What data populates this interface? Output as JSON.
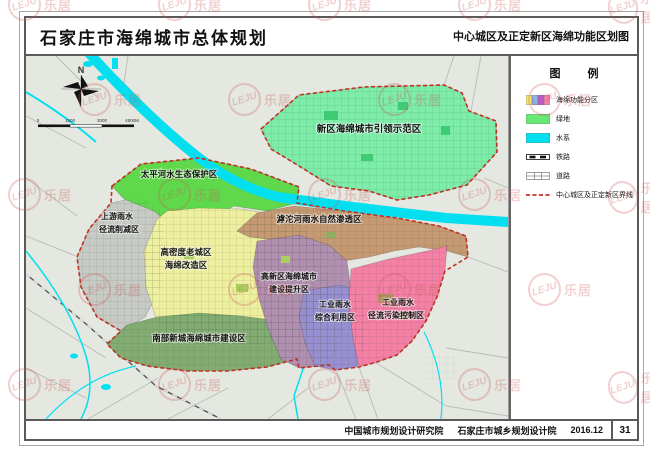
{
  "title_bar": {
    "left": "石家庄市海绵城市总体规划",
    "right": "中心城区及正定新区海绵功能区划图"
  },
  "compass": {
    "north_label": "N"
  },
  "scale_bar": {
    "ticks": [
      "0",
      "1500",
      "3000",
      "4500M"
    ]
  },
  "legend": {
    "title": "图 例",
    "items": [
      {
        "name": "sponge-function-zones",
        "label": "海绵功能分区",
        "colors": [
          "#f0e96e",
          "#8ab4ee",
          "#b95fd0",
          "#f583ab"
        ]
      },
      {
        "name": "green-space",
        "label": "绿地",
        "colors": [
          "#66e873"
        ]
      },
      {
        "name": "water-system",
        "label": "水系",
        "colors": [
          "#04dff0"
        ]
      },
      {
        "name": "railway",
        "label": "铁路",
        "colors": [
          "#222222"
        ]
      },
      {
        "name": "road",
        "label": "道路",
        "colors": [
          "#888888"
        ]
      },
      {
        "name": "boundary",
        "label": "中心城区及正定新区界线",
        "colors": [
          "#d42b20"
        ]
      }
    ]
  },
  "map": {
    "background": "#e4e8e1",
    "water_color": "#04dff0",
    "boundary_color": "#c03022",
    "zones": [
      {
        "id": "xinqu",
        "label": "新区海绵城市引领示范区",
        "label2": "",
        "color": "#7deda9"
      },
      {
        "id": "taipinghe",
        "label": "太平河水生态保护区",
        "label2": "",
        "color": "#5fd84b"
      },
      {
        "id": "shangyou",
        "label": "上游雨水",
        "label2": "径流削减区",
        "color": "#c7cac5"
      },
      {
        "id": "gaomidu",
        "label": "高密度老城区",
        "label2": "海绵改造区",
        "color": "#eef0a0"
      },
      {
        "id": "hutuohe",
        "label": "滹沱河雨水自然渗透区",
        "label2": "",
        "color": "#c59972"
      },
      {
        "id": "gaoxinqu",
        "label": "高新区海绵城市",
        "label2": "建设提升区",
        "color": "#b18fb0"
      },
      {
        "id": "gongye-liyong",
        "label": "工业雨水",
        "label2": "综合利用区",
        "color": "#988fd0"
      },
      {
        "id": "gongye-wuran",
        "label": "工业雨水",
        "label2": "径流污染控制区",
        "color": "#f480a6"
      },
      {
        "id": "nanbu",
        "label": "南部新城海绵城市建设区",
        "label2": "",
        "color": "#83ac72"
      }
    ]
  },
  "footer": {
    "org1": "中国城市规划设计研究院",
    "org2": "石家庄市城乡规划设计院",
    "date": "2016.12",
    "page": "31"
  },
  "watermark": {
    "logo": "LEJU",
    "text": "乐居"
  }
}
